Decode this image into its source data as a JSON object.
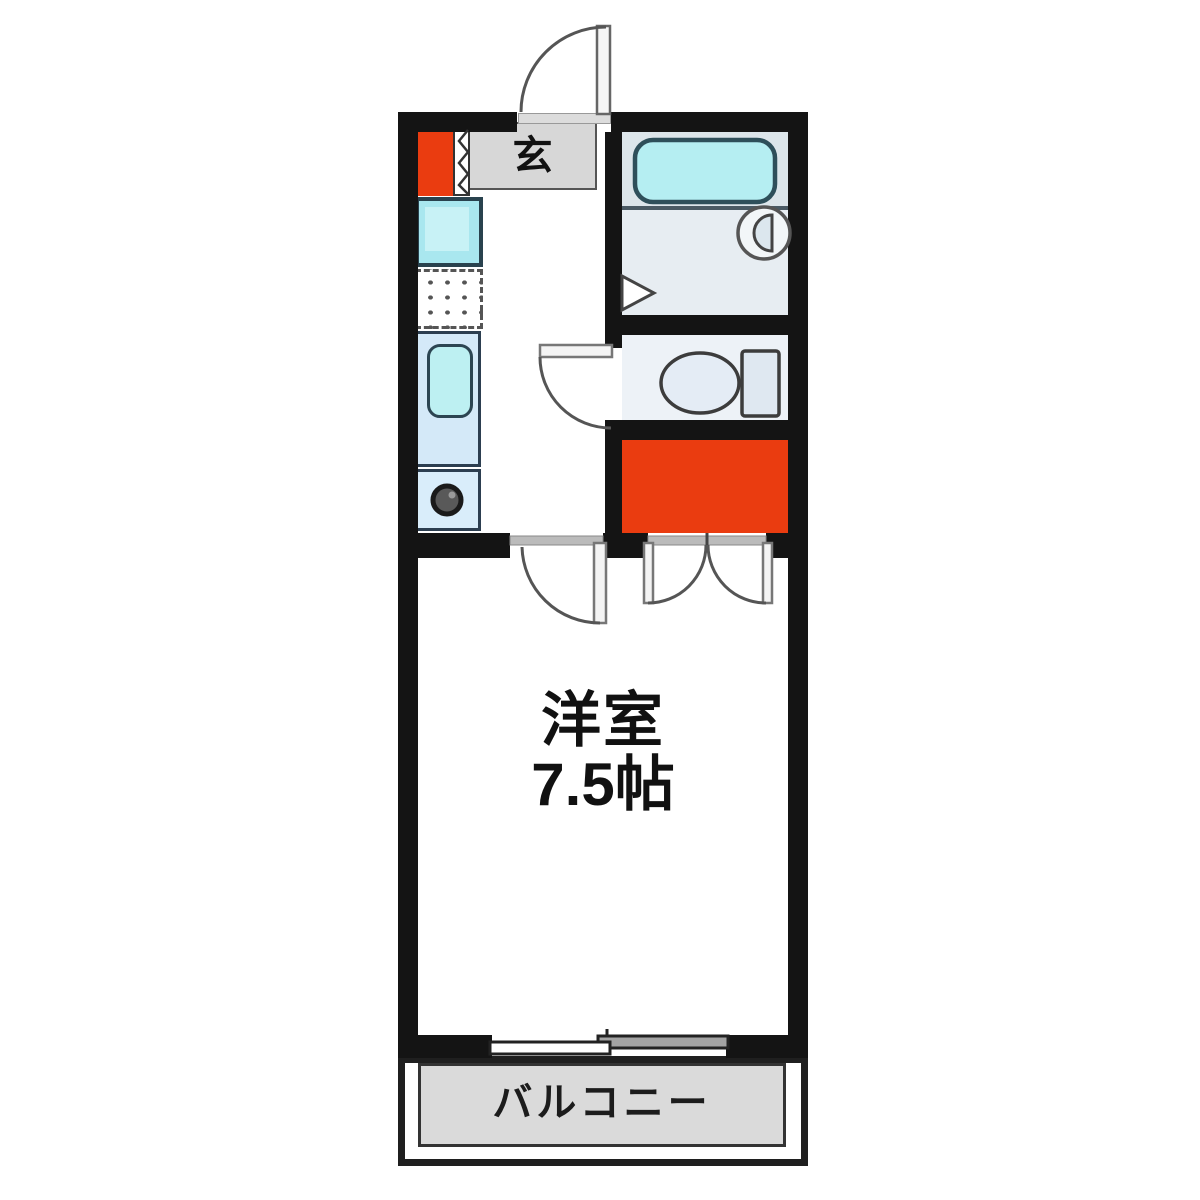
{
  "floorplan": {
    "labels": {
      "entrance": "玄",
      "room_name": "洋室",
      "room_size": "7.5帖",
      "balcony": "バルコニー"
    },
    "colors": {
      "wall": "#141414",
      "accent_red": "#ea3c10",
      "fixture_cyan": "#b5eef2",
      "counter_blue": "#d4e9f8",
      "entrance_gray": "#d7d7d7",
      "balcony_gray": "#dadada",
      "bath_floor": "#dce5ea",
      "background": "#ffffff"
    }
  }
}
